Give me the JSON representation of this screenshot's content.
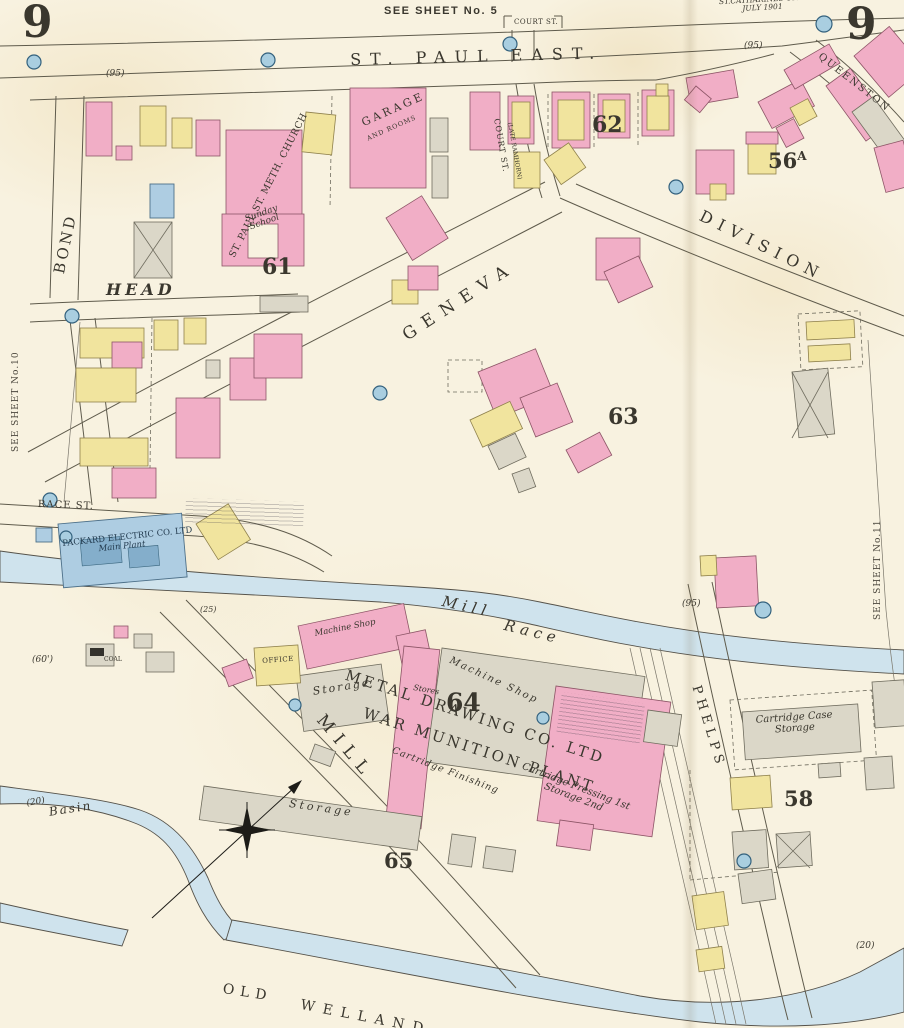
{
  "sheet": {
    "number_left": "9",
    "number_right": "9",
    "see_sheet_top": "SEE SHEET No. 5",
    "see_sheet_left": "SEE SHEET No.10",
    "see_sheet_right": "SEE SHEET No.11",
    "city": "ST.CATHARINES ONT.",
    "date": "JULY 1901"
  },
  "streets": {
    "st_paul_east": "ST. PAUL EAST.",
    "court_box": "COURT ST.",
    "court_vertical": "COURT ST.",
    "court_former": "(LATE RAMHORN)",
    "queenston": "QUEENSTON",
    "division": "DIVISION",
    "geneva": "GENEVA",
    "bond": "BOND",
    "head": "HEAD",
    "race_st": "RACE ST.",
    "mill": "MILL",
    "phelps": "PHELPS"
  },
  "blocks": {
    "b61": "61",
    "b62": "62",
    "b63": "63",
    "b64": "64",
    "b65": "65",
    "b58": "58",
    "b56": "56",
    "b56_sup": "A"
  },
  "buildings": {
    "church": "ST. PAUL ST. METH. CHURCH",
    "sunday_school_1": "Sunday",
    "sunday_school_2": "School",
    "garage": "GARAGE",
    "garage_sub": "AND ROOMS",
    "packard_1": "PACKARD ELECTRIC CO. LTD",
    "packard_2": "Main Plant",
    "office": "OFFICE",
    "coal": "COAL",
    "storage_west": "Storage",
    "storage_long": "Storage",
    "machine_shop_pink": "Machine Shop",
    "machine_shop_gray": "Machine Shop",
    "stores": "Stores",
    "metal_drawing": "METAL DRAWING CO. LTD",
    "war_munition": "WAR MUNITION PLANT",
    "cartridge_finishing": "Cartridge Finishing",
    "cartridge_pressing_1": "Cartridge Pressing 1st",
    "cartridge_pressing_2": "Storage 2nd",
    "cartridge_case_1": "Cartridge Case",
    "cartridge_case_2": "Storage"
  },
  "water": {
    "mill_race_1": "Mill",
    "mill_race_2": "Race",
    "basin": "Basin",
    "old_welland_1": "OLD",
    "old_welland_2": "WELLAND"
  },
  "annotations": {
    "a95_left": "(95)",
    "a95_right": "(95)",
    "a95_mid": "(95)",
    "a60": "(60')",
    "a25": "(25)",
    "a20_left": "(20)",
    "a20_right": "(20)"
  }
}
